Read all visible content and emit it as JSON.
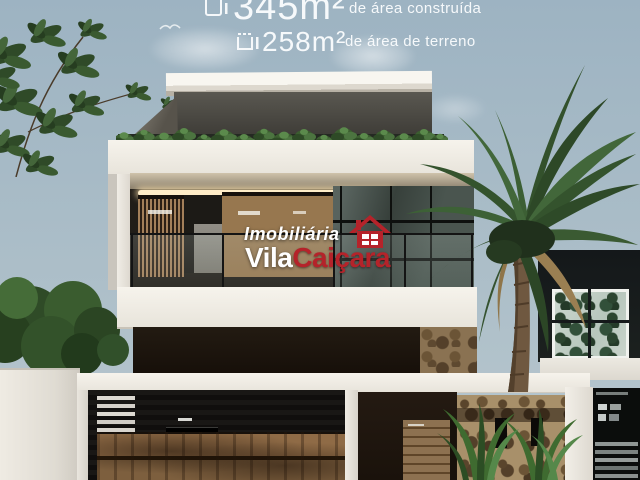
{
  "photo_overlay": {
    "built_area_value": "345m²",
    "built_area_label": "de área construída",
    "land_area_value": "258m²",
    "land_area_label": "de área de terreno"
  },
  "watermark": {
    "brand_top": "Imobiliária",
    "brand_white": "Vila",
    "brand_red": "Caiçara"
  },
  "palette": {
    "sky": "#a9bcc7",
    "brand_red": "#b5232a",
    "overlay_text": "#fdfeff"
  }
}
